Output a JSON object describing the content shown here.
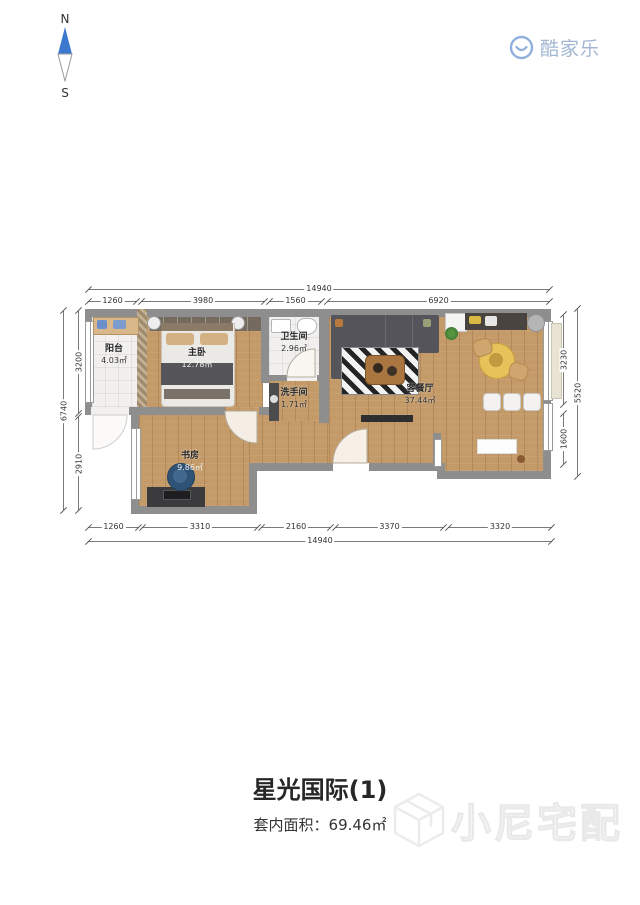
{
  "compass": {
    "north_label": "N",
    "south_label": "S"
  },
  "logo": {
    "name": "酷家乐"
  },
  "floorplan": {
    "rooms": [
      {
        "name": "阳台",
        "area": "4.03㎡"
      },
      {
        "name": "主卧",
        "area": "12.78㎡"
      },
      {
        "name": "卫生间",
        "area": "2.96㎡"
      },
      {
        "name": "洗手间",
        "area": "1.71㎡"
      },
      {
        "name": "客餐厅",
        "area": "37.44㎡"
      },
      {
        "name": "书房",
        "area": "9.86㎡"
      }
    ],
    "dimensions": {
      "top_total": "14940",
      "top_segments": [
        "1260",
        "3980",
        "1560",
        "6920"
      ],
      "bottom_segments": [
        "1260",
        "3310",
        "2160",
        "3370",
        "3320"
      ],
      "bottom_total": "14940",
      "left_outer": "6740",
      "left_segments": [
        "3200",
        "2910"
      ],
      "right_segments": [
        "3230",
        "1600"
      ],
      "right_outer": "5520"
    },
    "colors": {
      "wall": "#8e8e8e",
      "wood_floor": "#c49a68",
      "tile_floor": "#f1f0ee",
      "compass_blue": "#3d78cf",
      "logo_blue": "#a3b7d3"
    }
  },
  "footer": {
    "title": "星光国际(1)",
    "area_label": "套内面积：",
    "area_value": "69.46㎡"
  },
  "watermark": {
    "text": "小尼宅配"
  }
}
